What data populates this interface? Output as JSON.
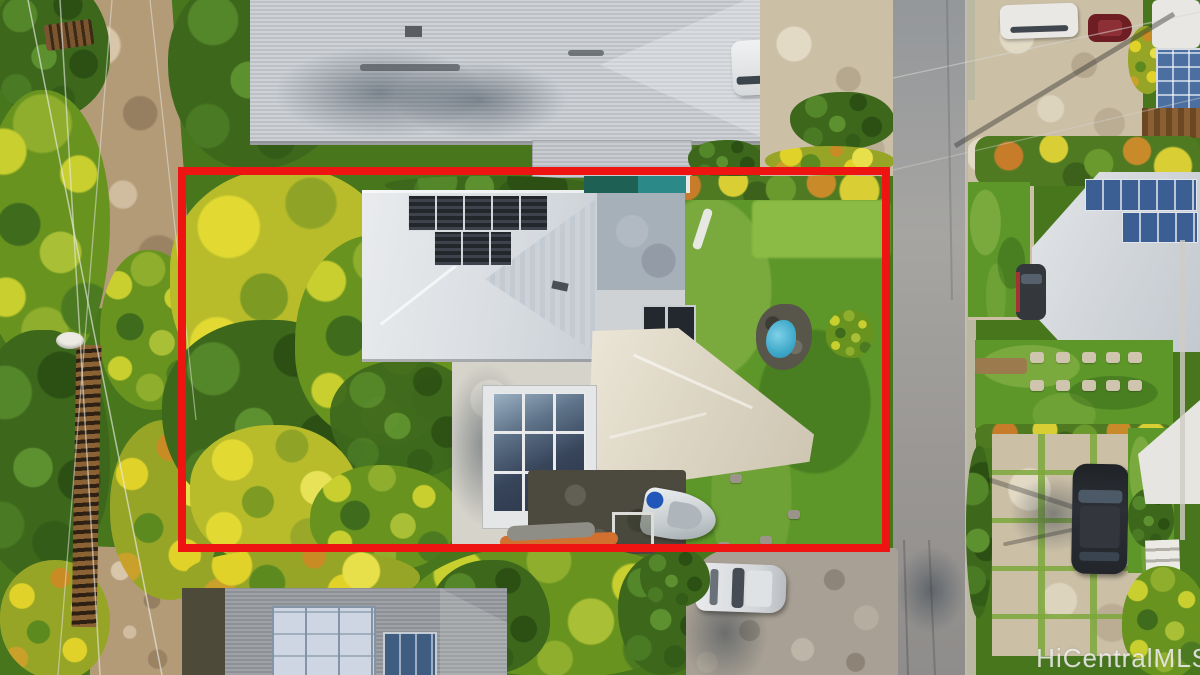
{
  "image": {
    "kind": "aerial-drone-photo",
    "width_px": 1200,
    "height_px": 675
  },
  "watermark": {
    "text": "HiCentralMLS"
  },
  "scene": {
    "description": "Overhead aerial view of a residential lot outlined in red, showing a main house with rooftop solar panels, a detached garage with a large solar array, a covered lap pool, a small blue pool, lawn, a large tree, a boat and paddleboards, neighboring homes with solar roofs, and a street with parked cars.",
    "objects": [
      "property-boundary-outline",
      "main-house-roof",
      "rooftop-solar-panels",
      "detached-garage-solar-array",
      "lap-pool",
      "small-blue-pool",
      "lawn",
      "large-tree",
      "palm-vegetation",
      "boat",
      "paddleboards",
      "street",
      "curb",
      "parked-white-suv",
      "parked-dark-suv",
      "parked-white-car",
      "stone-paver-driveway",
      "ribbon-driveway",
      "stepping-stones",
      "power-lines",
      "wood-fence",
      "neighbor-house-top",
      "neighbor-house-bottom",
      "neighbor-house-right",
      "watermark"
    ]
  },
  "palette": {
    "red_outline": "#ee1411",
    "lawn": "#5d9629",
    "veg_dark": "#3d681c",
    "veg_yellow": "#c9cf2e",
    "dirt": "#b49b78",
    "concrete": "#cbbfa6",
    "road_asphalt": "#9a9a98",
    "roof_light": "#dadee2",
    "roof_gray": "#c9cdd2",
    "roof_beige": "#ddd6c4",
    "roof_dark": "#94989c",
    "flat_roof": "#a6b0b9",
    "solar_dark": "#23262b",
    "solar_blue": "#3b5f93",
    "pool_teal": "#2b8a88",
    "pool_blue": "#3fa9c9",
    "stone_paving": "#a8a094",
    "gravel": "#4c493f",
    "car_white": "#e8eaec",
    "car_dark": "#25282d",
    "wood_fence": "#8a6234",
    "watermark_color": "rgba(245,245,245,0.82)"
  }
}
